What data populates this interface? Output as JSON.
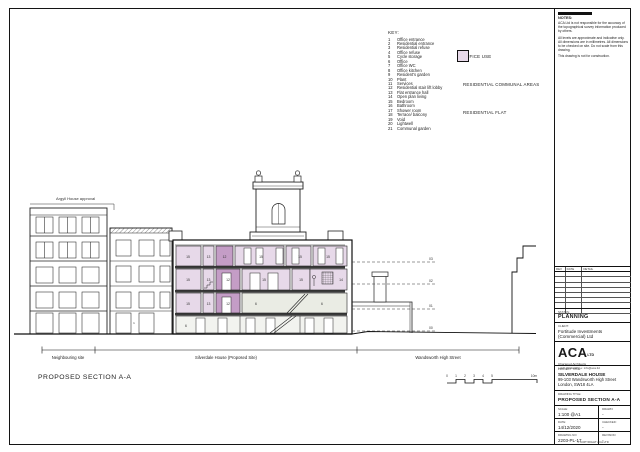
{
  "colors": {
    "office": "#eaece4",
    "communal": "#c49dc6",
    "flat": "#e7d9e9"
  },
  "key": {
    "title": "KEY:",
    "items": [
      {
        "num": "1",
        "label": "Office entrance"
      },
      {
        "num": "2",
        "label": "Residential entrance"
      },
      {
        "num": "3",
        "label": "Residential refuse"
      },
      {
        "num": "4",
        "label": "Office refuse"
      },
      {
        "num": "5",
        "label": "Cycle storage"
      },
      {
        "num": "6",
        "label": "Office"
      },
      {
        "num": "7",
        "label": "Office WC"
      },
      {
        "num": "8",
        "label": "Office kitchen"
      },
      {
        "num": "9",
        "label": "Resident's garden"
      },
      {
        "num": "10",
        "label": "Plant"
      },
      {
        "num": "11",
        "label": "Services"
      },
      {
        "num": "12",
        "label": "Residential stair lift lobby"
      },
      {
        "num": "13",
        "label": "Flat entrance hall"
      },
      {
        "num": "14",
        "label": "Open plan living"
      },
      {
        "num": "15",
        "label": "Bedroom"
      },
      {
        "num": "16",
        "label": "Bathroom"
      },
      {
        "num": "17",
        "label": "Shower room"
      },
      {
        "num": "18",
        "label": "Terrace/ balcony"
      },
      {
        "num": "19",
        "label": "Void"
      },
      {
        "num": "20",
        "label": "Lightwell"
      },
      {
        "num": "21",
        "label": "Communal garden"
      }
    ]
  },
  "legend": [
    {
      "label": "OFFICE USE",
      "color": "#eaece4"
    },
    {
      "label": "RESIDENTIAL COMMUNAL AREAS",
      "color": "#c49dc6"
    },
    {
      "label": "RESIDENTIAL FLAT",
      "color": "#e7d9e9"
    }
  ],
  "drawing": {
    "approval_note": "Argyll House approval",
    "entrance_label": "1",
    "levels": [
      "03",
      "02",
      "01",
      "00"
    ],
    "room_labels": {
      "f2": [
        "15",
        "13",
        "12",
        "15",
        "15",
        "15"
      ],
      "f1": [
        "15",
        "13",
        "12",
        "15",
        "15",
        "14"
      ],
      "f0": [
        "15",
        "13",
        "12",
        "6",
        "6"
      ],
      "lg": [
        "6"
      ]
    },
    "site_segments": [
      "Neighbouring site",
      "Silverdale House (Proposed Site)",
      "Wandsworth High Street"
    ],
    "caption": "PROPOSED SECTION A-A",
    "scale_bar": [
      "0",
      "1",
      "2",
      "3",
      "4",
      "5",
      "10m"
    ]
  },
  "title_block": {
    "notes": {
      "header": "NOTES:",
      "p1": "ACA Ltd is not responsible for the accuracy of the topographical survey information produced by others.",
      "p2": "All levels are approximate and indicative only. All dimensions are in millimetres. All dimensions to be checked on site. Do not scale from this drawing.",
      "p3": "This drawing is not for construction."
    },
    "revisions": {
      "headers": [
        "REV",
        "DATE",
        "DETAIL"
      ]
    },
    "status": {
      "label": "STATUS:",
      "value": "PLANNING"
    },
    "client": {
      "label": "CLIENT:",
      "line1": "Fortitude Investments",
      "line2": "(Commercial) Ltd"
    },
    "logo": {
      "name": "ACA",
      "suffix": "LTD",
      "tagline": "Chartered Architects",
      "contact": "t: 020 0000 0000  e: info@aca.ltd"
    },
    "project": {
      "label": "PROJECT TITLE:",
      "line1": "SILVERDALE HOUSE",
      "line2": "99-103 Wandsworth High Street",
      "line3": "London, SW18 4LA"
    },
    "drawing_title": {
      "label": "DRAWING TITLE:",
      "value": "PROPOSED SECTION A-A"
    },
    "fields": {
      "scale_label": "SCALE:",
      "scale": "1:100 @A1",
      "drawn_label": "DRAWN:",
      "drawn": "-",
      "date_label": "DATE:",
      "date": "14/12/2020",
      "checked_label": "CHECKED:",
      "checked": "-",
      "number_label": "DRAWING NO:",
      "number": "2203-PL-17",
      "rev_label": "REVISION:",
      "rev": "-"
    },
    "footer": "© COPYRIGHT ACA LTD"
  }
}
